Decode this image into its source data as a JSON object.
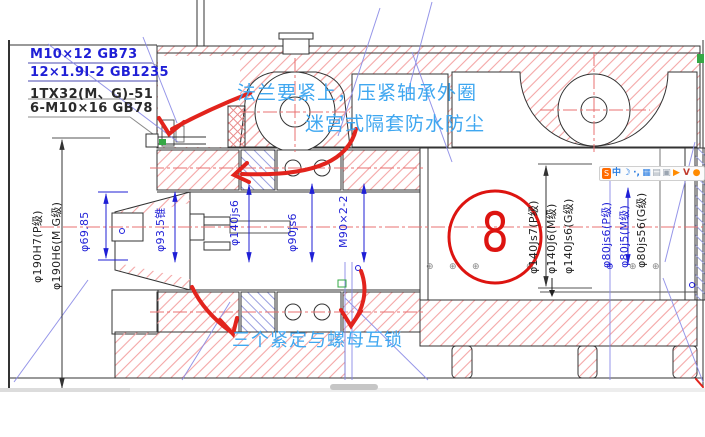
{
  "notes": [
    {
      "text": "M10×12 GB73"
    },
    {
      "text": "12×1.9Ⅰ-2 GB1235"
    },
    {
      "text": "1TX32(M、G)-51"
    },
    {
      "text": "6-M10×16 GB78"
    }
  ],
  "callouts": {
    "flange": "法兰要紧上，压紧轴承外圈",
    "labyrinth": "迷宫式隔套防水防尘",
    "locking": "三个紧定与螺母互锁",
    "balloon_number": "8"
  },
  "dims": {
    "left_housing_p": "φ190H7(P级)",
    "left_housing_mg": "φ190H6(M G级)",
    "nose_front": "φ69.85",
    "nose_taper": "φ93.5锥",
    "front_bearing": "φ140js6",
    "shaft_mid": "φ90js6",
    "thread": "M90×2-2",
    "rear_p": "φ140Js7(P级)",
    "rear_m": "φ140J6(M级)",
    "rear_g": "φ140Js6(G级)",
    "tail_p": "φ80js6(P级)",
    "tail_m": "φ80j5(M级)",
    "tail_g": "φ80js56(G级)"
  },
  "symbols": {
    "position_mark": "⊕"
  },
  "ime": {
    "icons": [
      {
        "name": "ime-logo",
        "glyph": "S"
      },
      {
        "name": "chinese-mode",
        "glyph": "中"
      },
      {
        "name": "half-width-moon",
        "glyph": "☽"
      },
      {
        "name": "punctuation",
        "glyph": "·,"
      },
      {
        "name": "soft-keyboard",
        "glyph": "▦"
      },
      {
        "name": "menu",
        "glyph": "▤"
      },
      {
        "name": "clipboard",
        "glyph": "▣"
      },
      {
        "name": "play",
        "glyph": "▶"
      },
      {
        "name": "voice",
        "glyph": "V"
      },
      {
        "name": "settings",
        "glyph": "●"
      }
    ]
  },
  "colors": {
    "cad_blue": "#1f1fd6",
    "hatch_red": "#f4a6a6",
    "hatch_blue": "#9aa0e0",
    "centerline_red": "#e87070",
    "annotation_red": "#e2241d",
    "annotation_blue": "#3fa7f0",
    "green_marker": "#35a845"
  }
}
